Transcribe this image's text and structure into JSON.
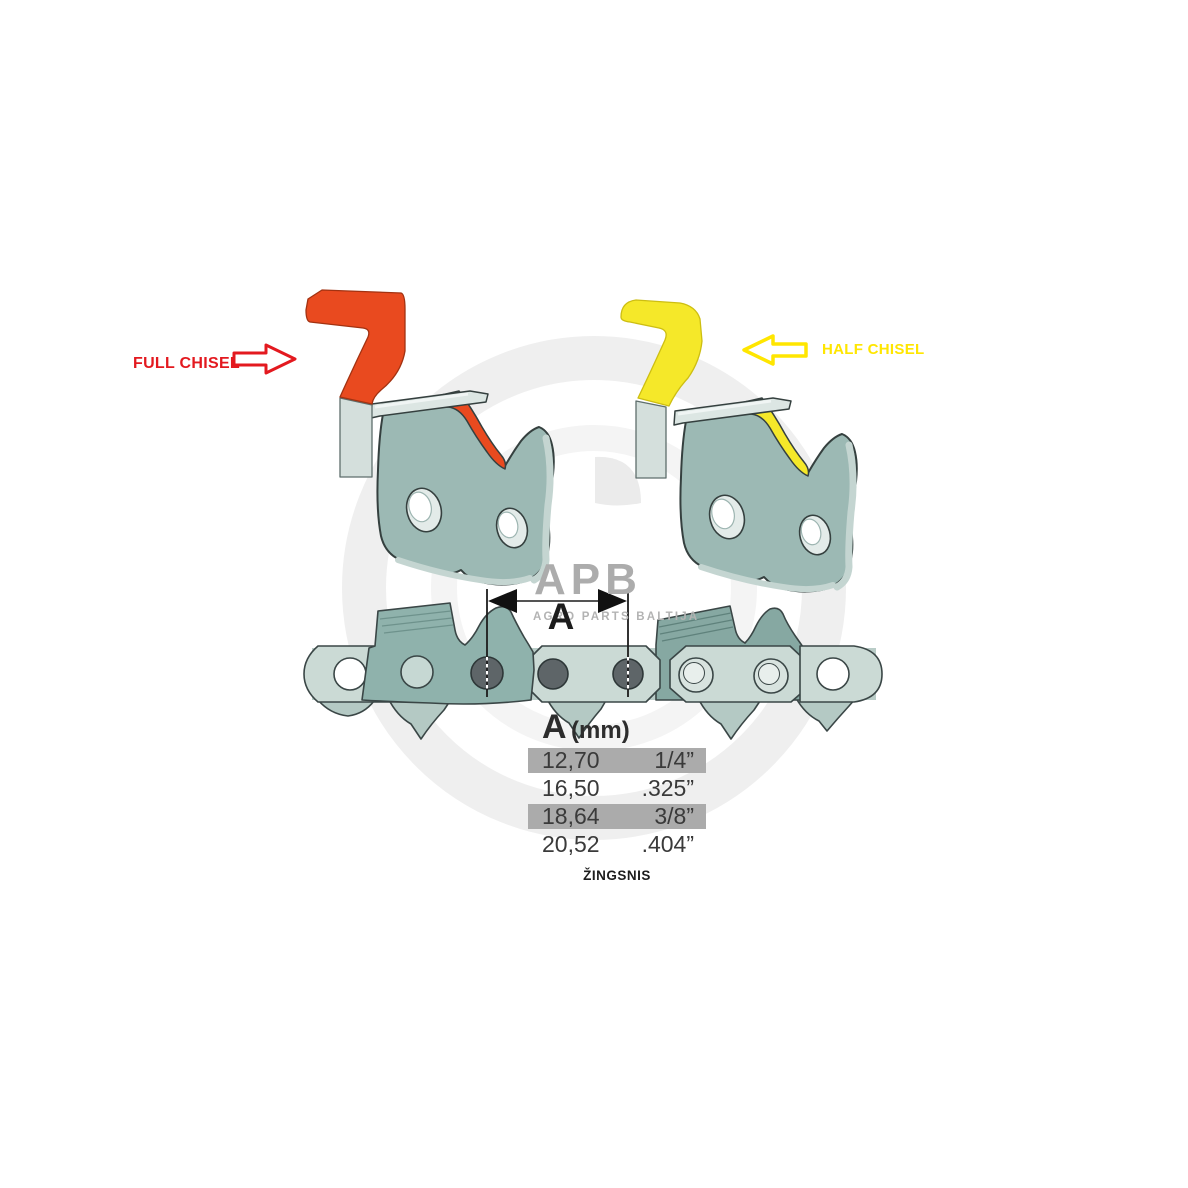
{
  "labels": {
    "full_chisel": "FULL CHISEL",
    "half_chisel": "HALF CHISEL"
  },
  "dimension": {
    "letter": "A"
  },
  "pitch_table": {
    "header": {
      "letter": "A",
      "unit": "(mm)"
    },
    "rows": [
      {
        "mm": "12,70",
        "inch": "1/4”",
        "highlighted": true
      },
      {
        "mm": "16,50",
        "inch": ".325”",
        "highlighted": false
      },
      {
        "mm": "18,64",
        "inch": "3/8”",
        "highlighted": true
      },
      {
        "mm": "20,52",
        "inch": ".404”",
        "highlighted": false
      }
    ],
    "caption": "ŽINGSNIS"
  },
  "watermark": {
    "logo": "APB",
    "subtext": "AGRO PARTS BALTIJA"
  },
  "icons": {
    "full_chisel_arrow": "arrow-right-outline",
    "half_chisel_arrow": "arrow-left-outline"
  },
  "colors": {
    "red_label": "#E3191F",
    "red_fill": "#E94A1F",
    "yellow_label": "#FFE600",
    "yellow_fill": "#F5E829",
    "steel_light": "#CBDAD5",
    "steel_dark": "#8FB2AC",
    "steel_far": "#86A8A2",
    "outline": "#3A4646",
    "rivet": "#5E6568",
    "table_highlight": "#ABABAB",
    "watermark_gray": "#ACACAC"
  }
}
